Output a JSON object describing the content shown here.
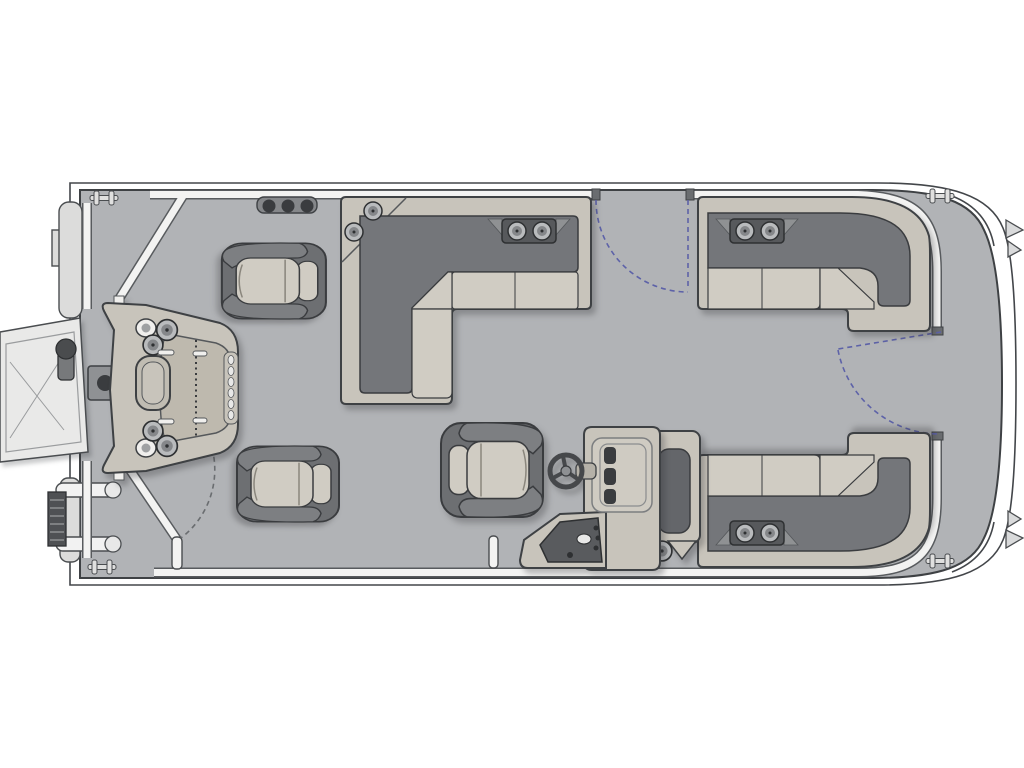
{
  "diagram": {
    "type": "pontoon-boat-floor-plan",
    "view": "top-down",
    "bow_side": "right",
    "stern_side": "left",
    "background": "#ffffff"
  },
  "colors": {
    "deck": "#b1b3b6",
    "hull_outline": "#43464a",
    "fence": "#f3f3f2",
    "fence_outline": "#585b5e",
    "furniture_frame": "#c8c4bb",
    "furniture_panel": "#beb9ae",
    "seat_cushion": "#d0ccc3",
    "backrest": "#74767a",
    "chair_shell": "#6d6f72",
    "dark_detail": "#3a3c3f",
    "door_arc_blue": "#5d62a8",
    "door_arc_gray": "#6a6d70",
    "metal_light": "#e9e9e8",
    "deck_pad": "#8f9194"
  },
  "components": {
    "hull": {
      "name": "pontoon-deck",
      "shape": "rounded-nose-right"
    },
    "boarding": {
      "ramp": "boarding-ramp-stern-port",
      "ladder": "boarding-ladder-stern",
      "end_cap": "pontoon-end-cap"
    },
    "gates": [
      {
        "name": "stern-gate",
        "arc_style": "gray-dashed"
      },
      {
        "name": "port-mid-gate",
        "arc_style": "blue-dashed"
      },
      {
        "name": "starboard-bow-gate",
        "arc_style": "blue-dashed"
      }
    ],
    "seating": {
      "fishing_chairs": 2,
      "captain_chair": 1,
      "lounges": [
        "port-l-lounge",
        "bow-l-lounge",
        "stern-l-lounge"
      ]
    },
    "helm": {
      "console": "helm-console",
      "steering_wheel": 1,
      "gauges": 3,
      "switch_panel": 1,
      "arm_rest_module": 1
    },
    "fixtures": {
      "cup_holder_trays": 3,
      "corner_cup_holders": 2,
      "deck_cup_holders": 2,
      "cleats": 4,
      "rail_knobs": 3,
      "deck_pad": 1,
      "fishing_station": {
        "holder_rings": 6,
        "measure_ruler": 1,
        "tool_slots": 6,
        "grab_handle": 1
      }
    }
  }
}
